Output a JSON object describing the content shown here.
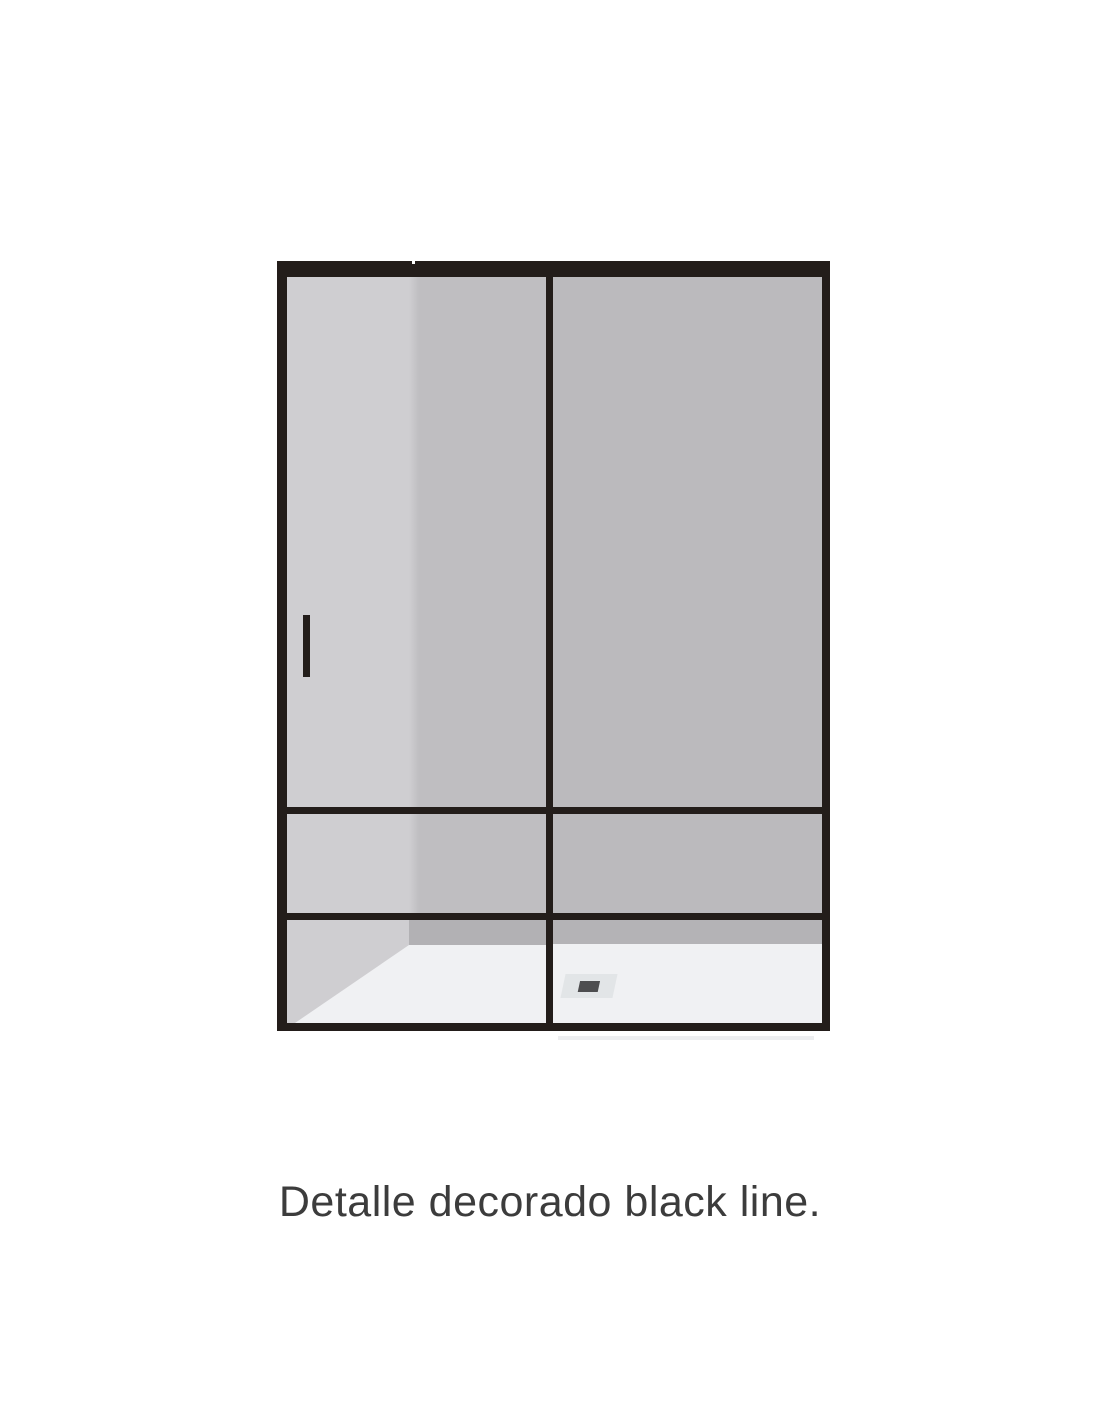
{
  "page": {
    "background": "#ffffff"
  },
  "illustration": {
    "name": "shower-enclosure-black-line-detail",
    "rows": 7,
    "columns": 2,
    "parts": [
      "top-rail",
      "left-post",
      "center-post",
      "right-post",
      "bottom-rail",
      "mullions",
      "door-handle",
      "shower-tray",
      "drain"
    ]
  },
  "colors": {
    "page-bg": "#ffffff",
    "frame": "#231d1a",
    "glass-left-light": "#cfced1",
    "glass-left-mid": "#bfbec1",
    "glass-right": "#bbbabd",
    "wall-strip-left": "#b2b1b4",
    "wall-strip-right": "#b4b3b6",
    "floor": "#f0f1f3",
    "drain-outer": "#e2e5e7",
    "drain-inner": "#4d4d4f",
    "shadow": "#edeef0",
    "caption": "#3c3c3c"
  },
  "caption": {
    "text": "Detalle decorado black line."
  }
}
